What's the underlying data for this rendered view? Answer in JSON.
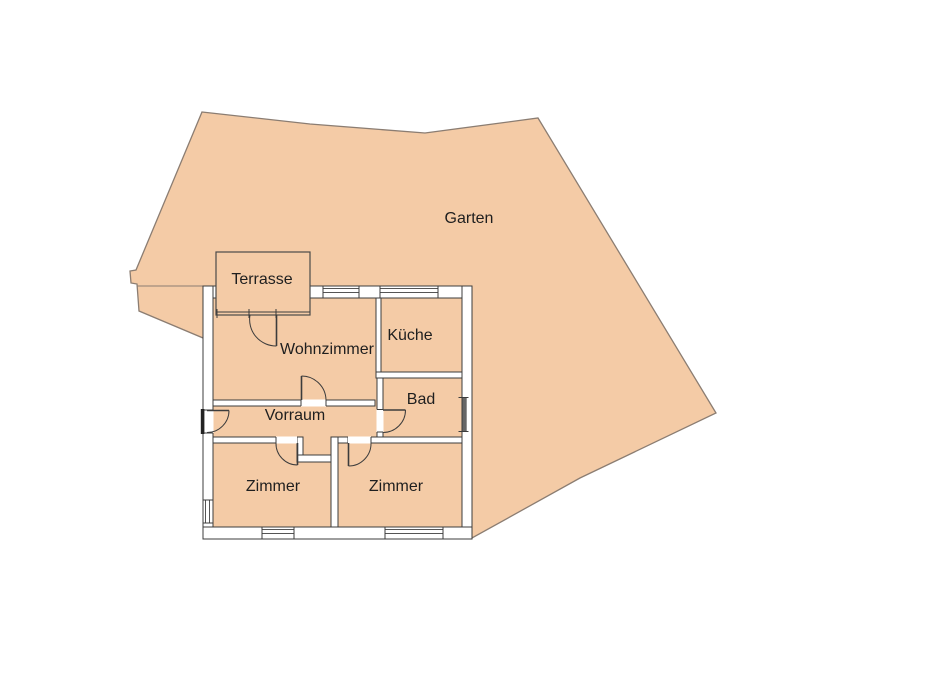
{
  "floorplan": {
    "type": "residential-floor-plan-with-garden",
    "labels": {
      "garden": "Garten",
      "terrace": "Terrasse",
      "living_room": "Wohnzimmer",
      "kitchen": "Küche",
      "bath": "Bad",
      "hall": "Vorraum",
      "room_left": "Zimmer",
      "room_right": "Zimmer"
    },
    "colors": {
      "area_fill": "#f4cba6",
      "garden_outline": "#8b7d72",
      "wall_line": "#3c3c3c",
      "wall_fill": "#ffffff",
      "glazing": "#555555",
      "background": "#ffffff",
      "text": "#1f1f1f"
    }
  }
}
